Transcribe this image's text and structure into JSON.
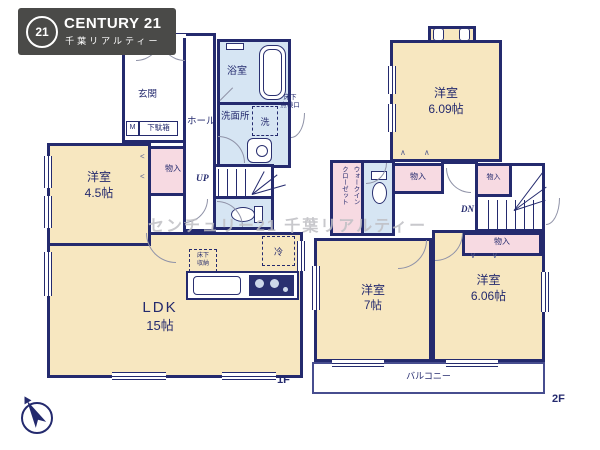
{
  "logo": {
    "badge": "21",
    "brand": "CENTURY 21",
    "subtitle": "千葉リアルティー"
  },
  "watermark": "センチュリー21 千葉リアルティー",
  "colors": {
    "wall": "#242a6e",
    "room_cream": "#f7e7c0",
    "closet_pink": "#f7dae2",
    "wet_blue": "#d6e5f3",
    "logo_gray": "#4a4a48",
    "watermark_gray": "#bfbfc4"
  },
  "marks": {
    "chevron_left": "<",
    "chevron_up": "∧∧",
    "chevron_down": "∨∨"
  },
  "floor1": {
    "floor_label": "1F",
    "genkan": "玄関",
    "shoe_m": "M",
    "shoe_box": "下駄箱",
    "hall": "ホール",
    "bath": "浴室",
    "washroom": "洗面所",
    "washer": "洗",
    "hatch_line1": "床下",
    "hatch_line2": "点検口",
    "up": "UP",
    "room45_name": "洋室",
    "room45_size": "4.5帖",
    "closet": "物入",
    "ldk_name": "LDK",
    "ldk_size": "15帖",
    "storage_line1": "床下",
    "storage_line2": "収納",
    "fridge": "冷"
  },
  "floor2": {
    "floor_label": "2F",
    "room609_name": "洋室",
    "room609_size": "6.09帖",
    "wic_line1": "ウォークイン",
    "wic_line2": "クローゼット",
    "closet_mid": "物入",
    "closet_stair": "物入",
    "closet_606": "物入",
    "dn": "DN",
    "room7_name": "洋室",
    "room7_size": "7帖",
    "room606_name": "洋室",
    "room606_size": "6.06帖",
    "balcony": "バルコニー"
  }
}
